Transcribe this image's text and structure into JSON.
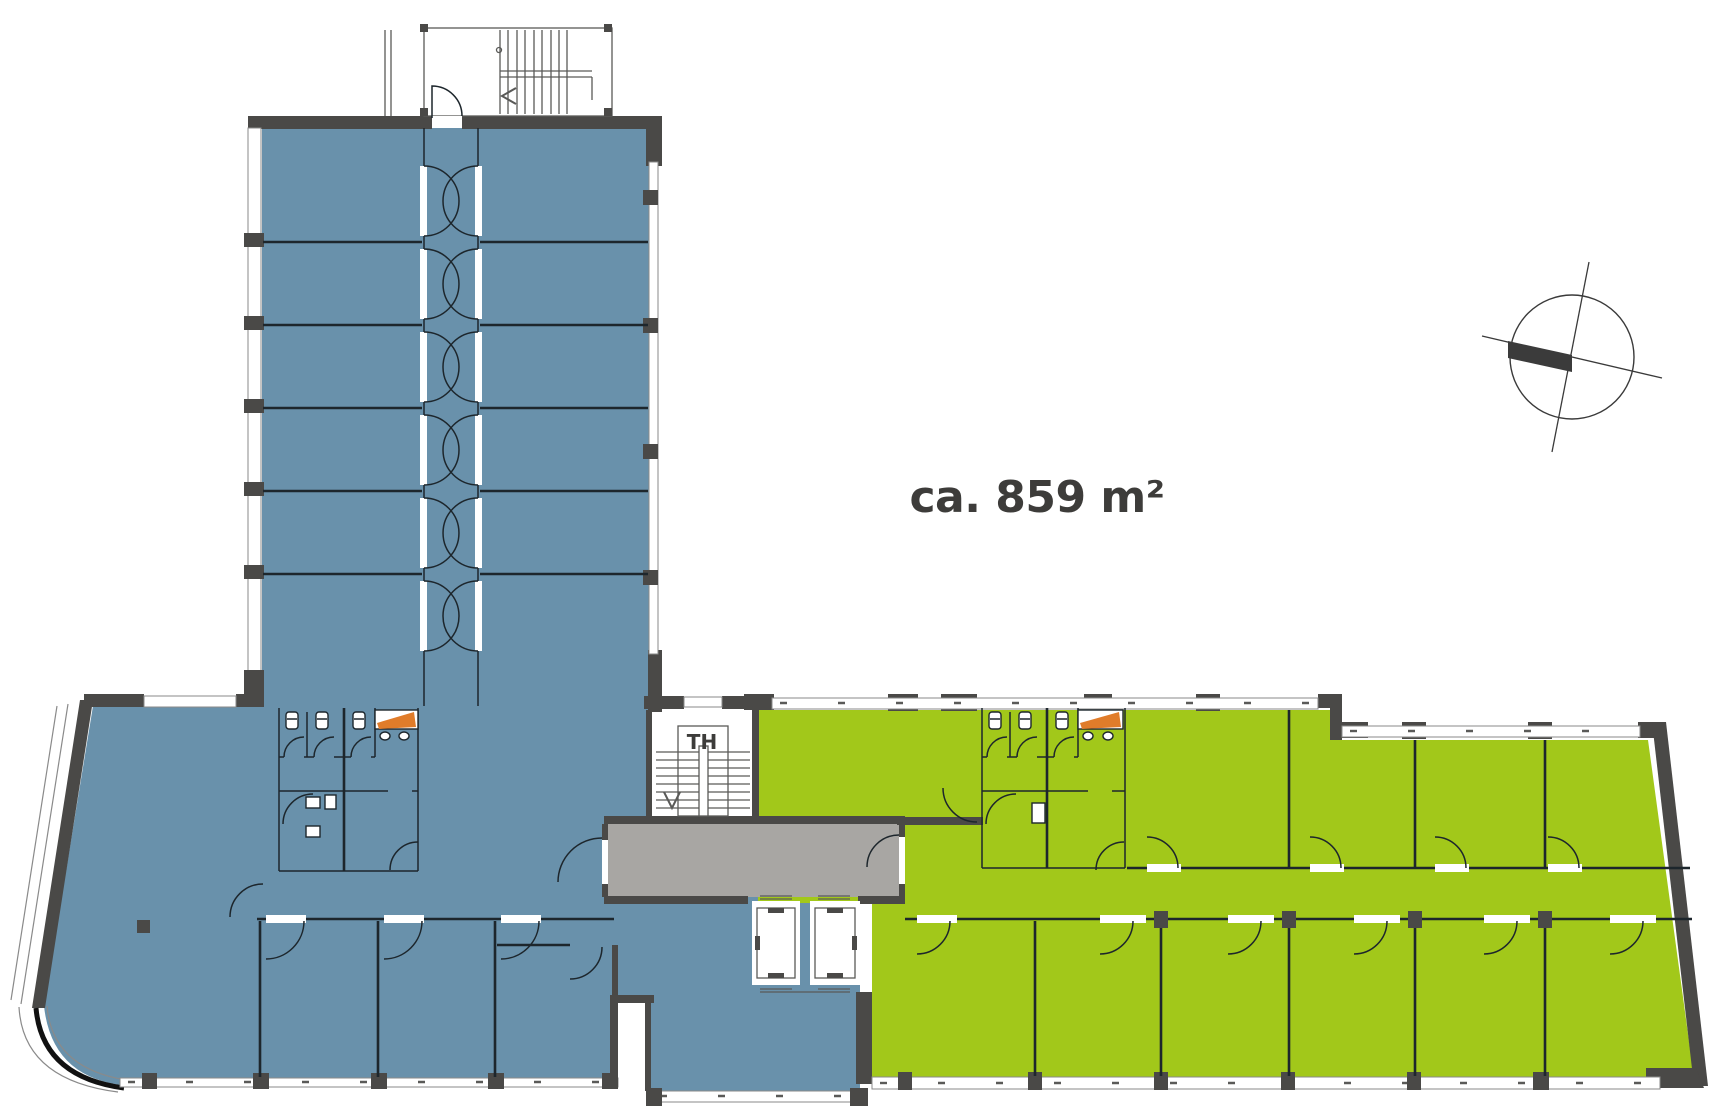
{
  "plan": {
    "labels": {
      "area_label": "ca. 859 m²",
      "stairwell_label": "TH"
    },
    "zones": {
      "left_unit": "blue rental unit (L-shaped wing)",
      "right_unit": "green rental unit (east wing)",
      "core": "stair and elevator core with corridor"
    },
    "icons": {
      "north_arrow": "circle with crossing survey lines and dark needle bar",
      "stairs_top": "switchback stair with treads and up arrow",
      "stairwell_core": "straight stair with treads and down arrow",
      "elevator": "two shafts with cars",
      "toilet": "small cistern-and-bowl glyph",
      "sink": "small oval basin",
      "vanity_counter": "orange counter wedge"
    },
    "colors": {
      "wall": "#4a4947",
      "unit_left": "#6991ab",
      "unit_right": "#a2c81a",
      "corridor": "#a8a6a3",
      "accent": "#e07c2a",
      "line": "#1d262c",
      "window_line": "#8a8a8a",
      "text": "#3d3c3a"
    }
  }
}
